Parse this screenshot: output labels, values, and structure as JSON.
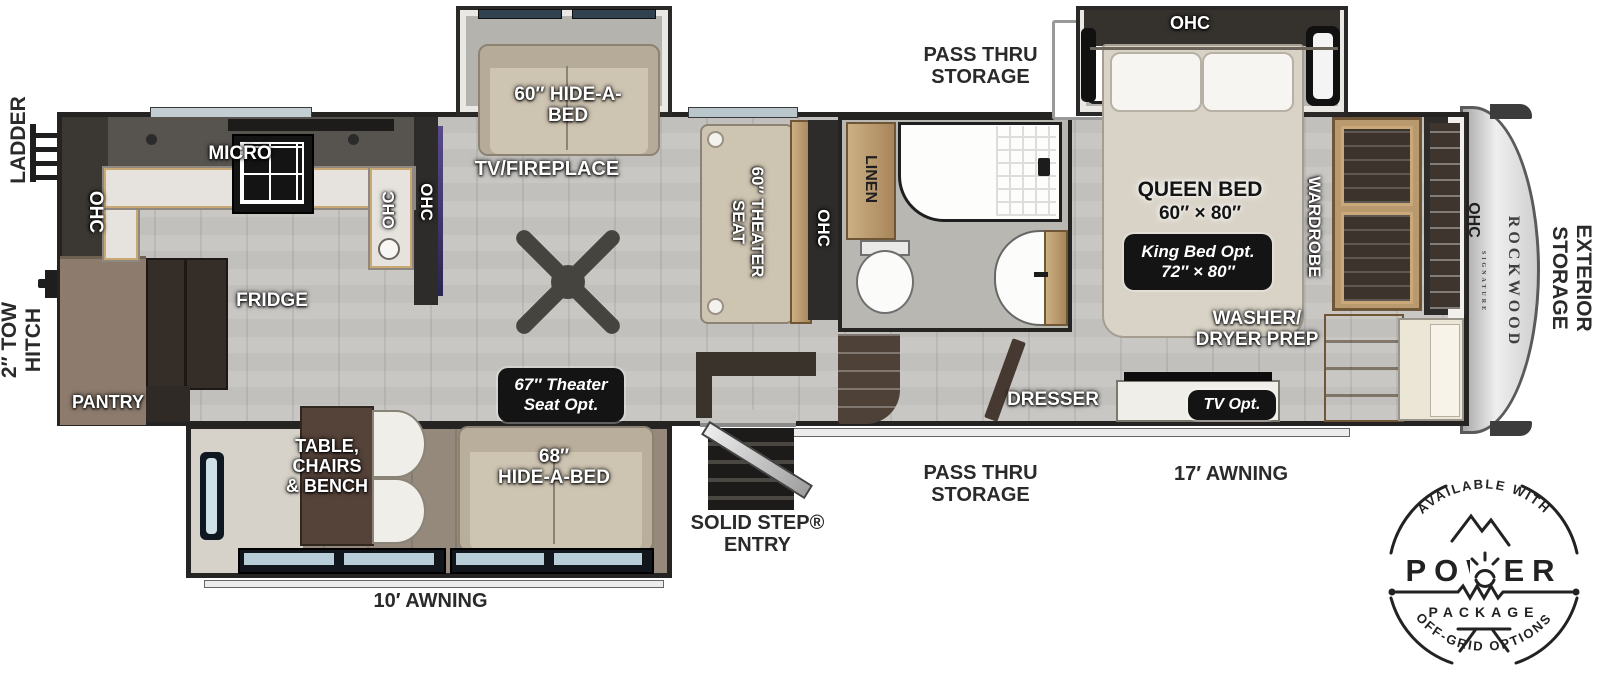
{
  "exterior": {
    "ladder": "LADDER",
    "tow_hitch": "2″ TOW\nHITCH",
    "pass_thru_storage_top": "PASS THRU\nSTORAGE",
    "pass_thru_storage_bottom": "PASS THRU\nSTORAGE",
    "solid_step_entry": "SOLID STEP®\nENTRY",
    "awning_10": "10′ AWNING",
    "awning_17": "17′ AWNING",
    "exterior_storage": "EXTERIOR\nSTORAGE",
    "brand": "ROCKWOOD",
    "brand_sub": "SIGNATURE"
  },
  "kitchen": {
    "ohc_rear": "OHC",
    "micro": "MICRO",
    "ohc_sink": "OHC",
    "fridge": "FRIDGE",
    "pantry": "PANTRY"
  },
  "living": {
    "ohc_entertainment": "OHC",
    "tv_fireplace": "TV/FIREPLACE",
    "hide_a_bed_60": "60″ HIDE-A-\nBED",
    "theater_seat_60": "60″ THEATER\nSEAT",
    "ohc_theater": "OHC",
    "theater_seat_option": "67″ Theater\nSeat Opt.",
    "dinette": "TABLE,\nCHAIRS\n& BENCH",
    "hide_a_bed_68": "68″\nHIDE-A-BED"
  },
  "bath": {
    "linen": "LINEN"
  },
  "bedroom": {
    "ohc": "OHC",
    "queen_bed": "QUEEN BED",
    "queen_size": "60″ × 80″",
    "king_option": "King Bed Opt.\n72″ × 80″",
    "wardrobe": "WARDROBE",
    "washer_dryer": "WASHER/\nDRYER PREP",
    "dresser": "DRESSER",
    "tv_option": "TV Opt.",
    "ohc_front": "OHC"
  },
  "power_badge": {
    "available_with": "AVAILABLE WITH",
    "power": "POWER",
    "package": "PACKAGE",
    "off_grid": "OFF-GRID OPTIONS"
  }
}
